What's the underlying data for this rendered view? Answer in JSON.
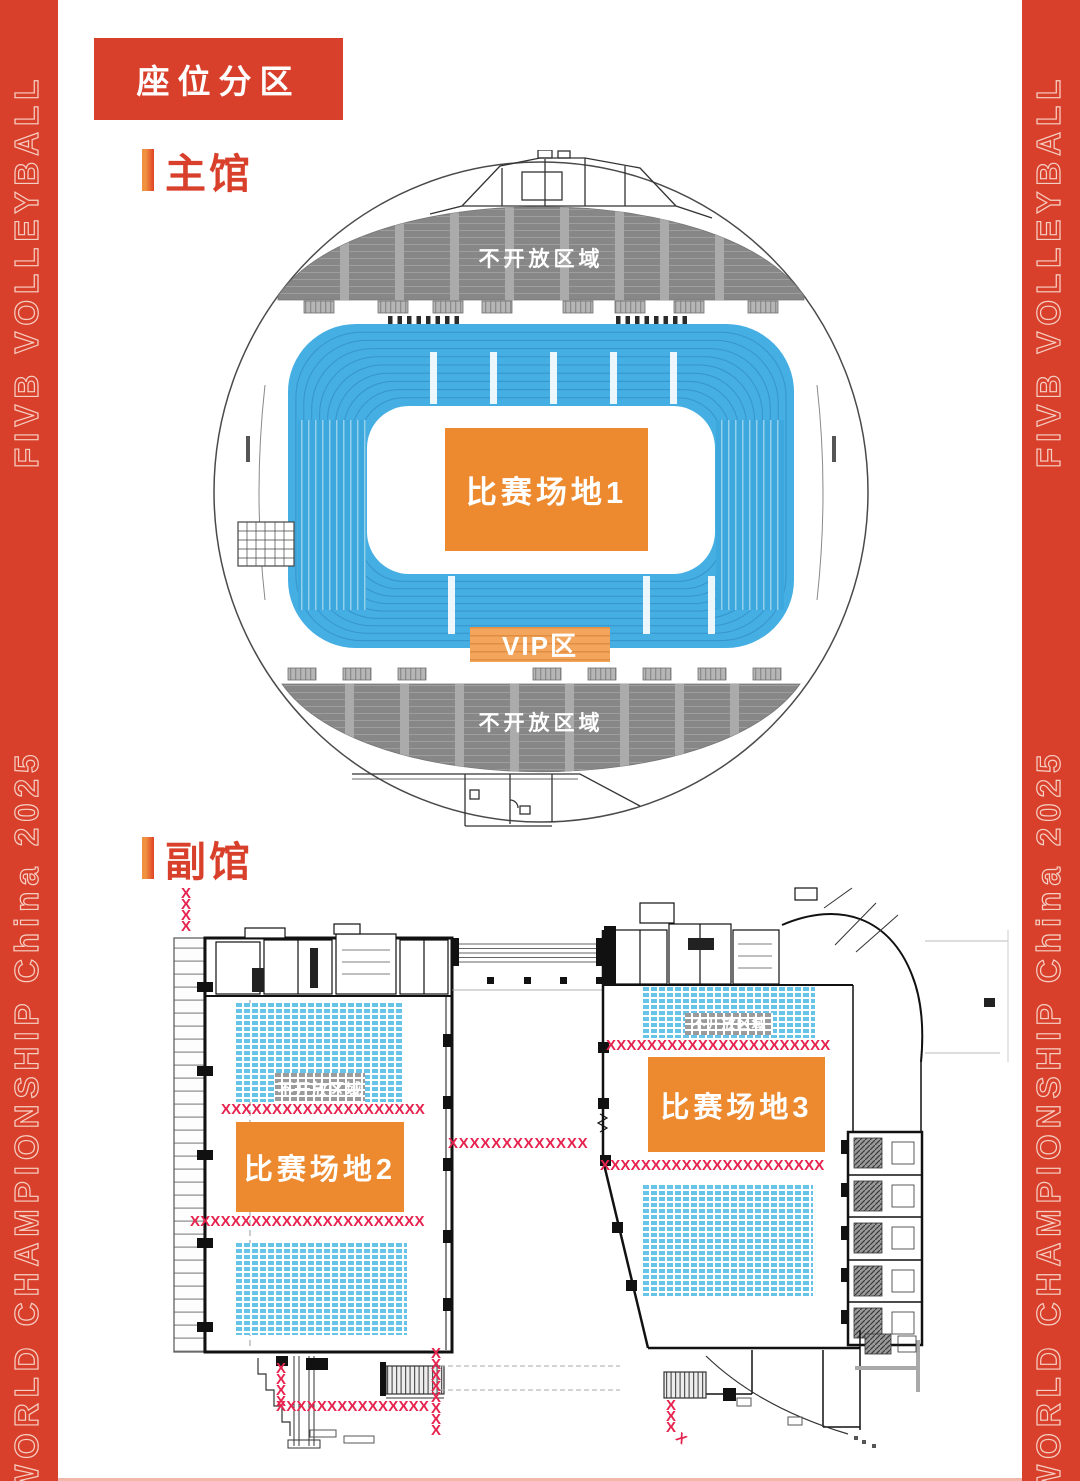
{
  "banner": {
    "line1": "FIVB VOLLEYBALL",
    "line2": "WORLD CHAMPIONSHIP China 2025"
  },
  "header": {
    "badge_label": "座位分区"
  },
  "main_hall": {
    "heading": "主馆",
    "closed_area_top": "不开放区域",
    "closed_area_bottom": "不开放区域",
    "court_label": "比赛场地1",
    "vip_label": "VIP区"
  },
  "aux_hall": {
    "heading": "副馆",
    "court2_label": "比赛场地2",
    "court3_label": "比赛场地3",
    "closed_area_left": "不开放区域",
    "closed_area_right": "不开放区域"
  },
  "barriers": {
    "top_left_col": "XXXX",
    "left_row_top": "XXXXXXXXXXXXXXXXXXXX",
    "left_row_bottom": "XXXXXXXXXXXXXXXXXXXXXXX",
    "corridor_row": "XXXXXXXXXXXXX",
    "right_row_top": "XXXXXXXXXXXXXXXXXXXXXX",
    "right_row_mid": "XXXXXXXXXXXXXXXXXXXXXX",
    "bottom_left_col": "XXXX",
    "bottom_mid_col": "XXXXXXXX",
    "bottom_row": "XXXXXXXXXXXXXXX",
    "bottom_right_col": "XXX",
    "bottom_right_tail": "X"
  },
  "colors": {
    "brand_red": "#d8402c",
    "court_orange": "#ed8a2f",
    "vip_orange": "#f3a55c",
    "stand_blue": "#45aee3",
    "seat_blue": "#68c3e9",
    "closed_gray": "#878787",
    "barrier_crimson": "#e6234e"
  }
}
